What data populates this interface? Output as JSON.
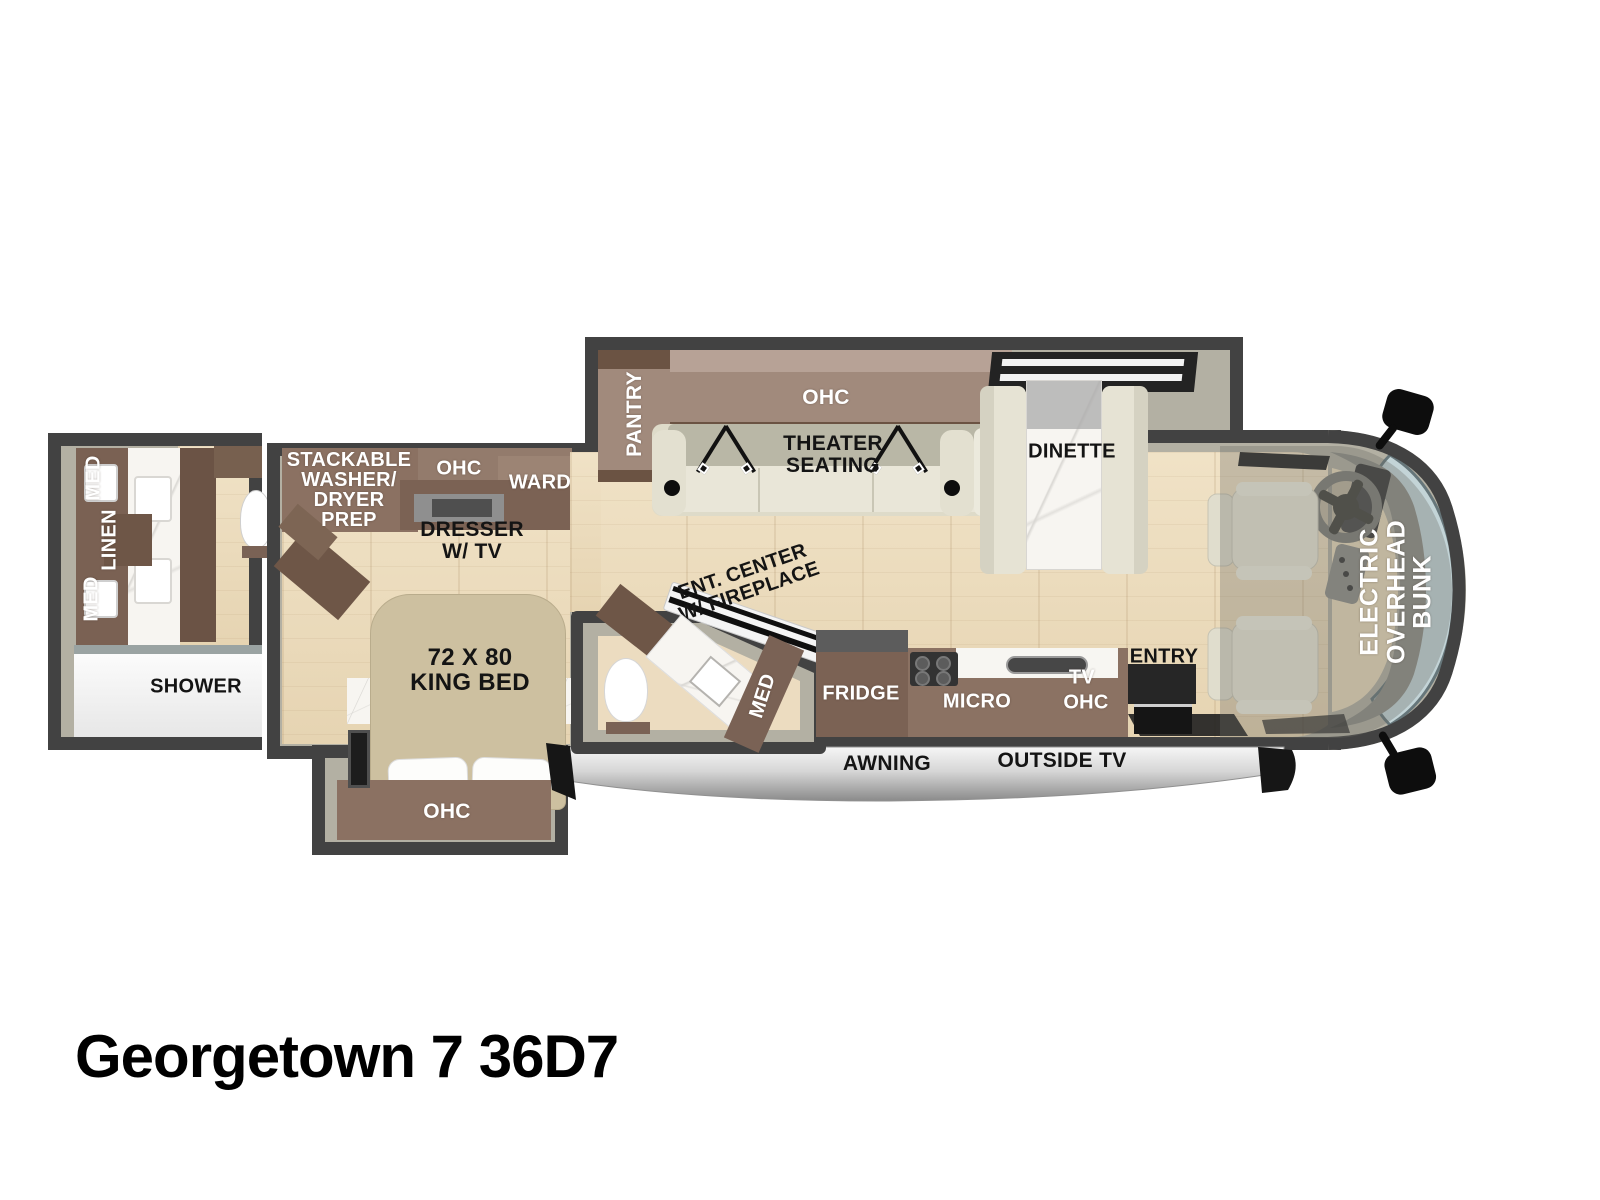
{
  "title": "Georgetown 7 36D7",
  "palette": {
    "wall": "#424242",
    "interior_band": "#b3b0a3",
    "wood_floor": "#ecdcbe",
    "cabinet_brown": "#8b7263",
    "cabinet_dark": "#6b5345",
    "cabinet_mauve": "#a18a7c",
    "seat_cream": "#e8e5d7",
    "marble_white": "#f7f5f1",
    "windshield_glass": "#c3d4d7",
    "awning_gray": "#d6d6d6",
    "accent_black": "#161616"
  },
  "bath": {
    "med1": "MED",
    "linen": "LINEN",
    "med2": "MED",
    "shower": "SHOWER"
  },
  "bedroom": {
    "wd": {
      "l1": "STACKABLE",
      "l2": "WASHER/",
      "l3": "DRYER",
      "l4": "PREP"
    },
    "ohc": "OHC",
    "ward": "WARD",
    "dresser": {
      "l1": "DRESSER",
      "l2": "W/ TV"
    },
    "bed": {
      "l1": "72 X 80",
      "l2": "KING BED"
    },
    "ohc_slide": "OHC"
  },
  "living": {
    "pantry": "PANTRY",
    "ohc": "OHC",
    "theater": {
      "l1": "THEATER",
      "l2": "SEATING"
    },
    "dinette": "DINETTE",
    "ent": {
      "l1": "ENT. CENTER",
      "l2": "W/ FIREPLACE"
    }
  },
  "half_bath": {
    "med": "MED"
  },
  "kitchen": {
    "fridge": "FRIDGE",
    "micro": "MICRO",
    "tv": "TV",
    "ohc": "OHC",
    "entry": "ENTRY"
  },
  "cab": {
    "bunk": {
      "l1": "ELECTRIC",
      "l2": "OVERHEAD",
      "l3": "BUNK"
    }
  },
  "exterior": {
    "awning": "AWNING",
    "outside_tv": "OUTSIDE TV"
  }
}
